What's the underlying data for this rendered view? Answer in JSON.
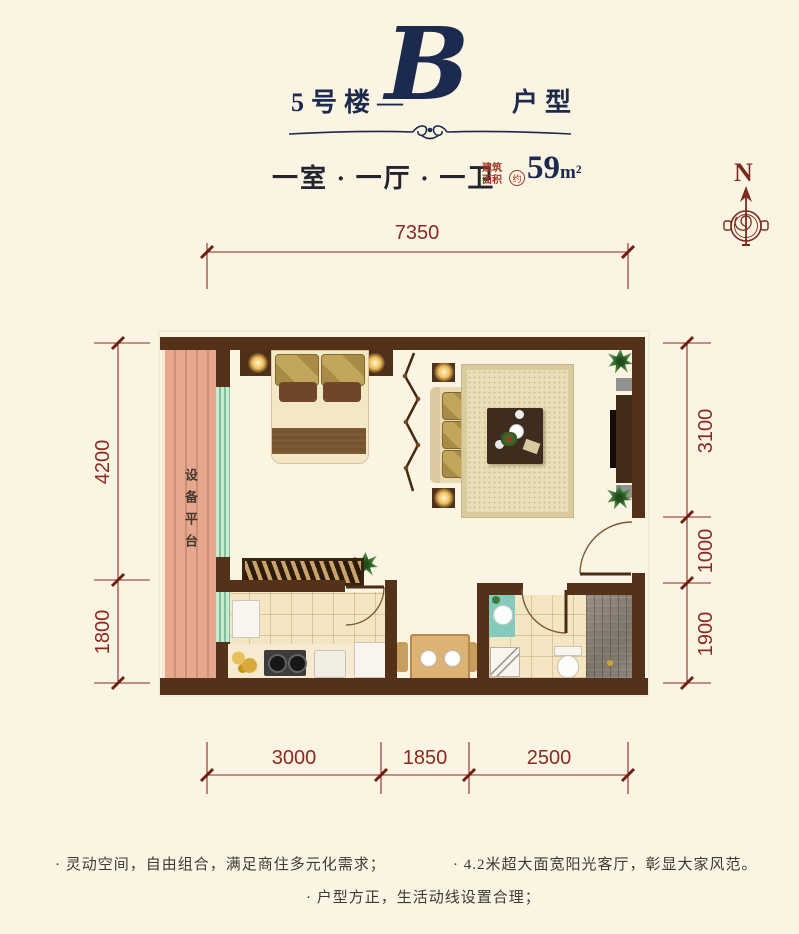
{
  "title": {
    "building": "5号楼—",
    "letter": "B",
    "suffix": "户型"
  },
  "subtitle": {
    "rooms": "一室 · 一厅 · 一卫",
    "area_label_1": "建筑",
    "area_label_2": "面积",
    "approx": "约",
    "area_value": "59",
    "area_unit": "m²"
  },
  "compass": {
    "north": "N"
  },
  "dimensions": {
    "top": [
      "7350"
    ],
    "left": [
      "4200",
      "1800"
    ],
    "right": [
      "3100",
      "1000",
      "1900"
    ],
    "bottom": [
      "3000",
      "1850",
      "2500"
    ]
  },
  "plan": {
    "equipment_platform": "设备平台"
  },
  "features": {
    "left": "· 灵动空间，自由组合，满足商住多元化需求；",
    "right": "· 4.2米超大面宽阳光客厅，彰显大家风范。",
    "center": "· 户型方正，生活动线设置合理；"
  },
  "colors": {
    "background": "#fcf4e3",
    "title_navy": "#1b2a4e",
    "dimension_red": "#8a2a22",
    "compass_red": "#7c2a1f",
    "area_label_red": "#9e3826",
    "wall_brown": "#54321a",
    "wood_floor": "#e9cb99",
    "tile_floor": "#f4e5c3",
    "equipment_platform": "#e0a184",
    "window_green": "#9fd0ae",
    "shower_mosaic": "#877e73",
    "rug_beige": "#e9deb5",
    "cushion_gold": "#b3964e"
  }
}
